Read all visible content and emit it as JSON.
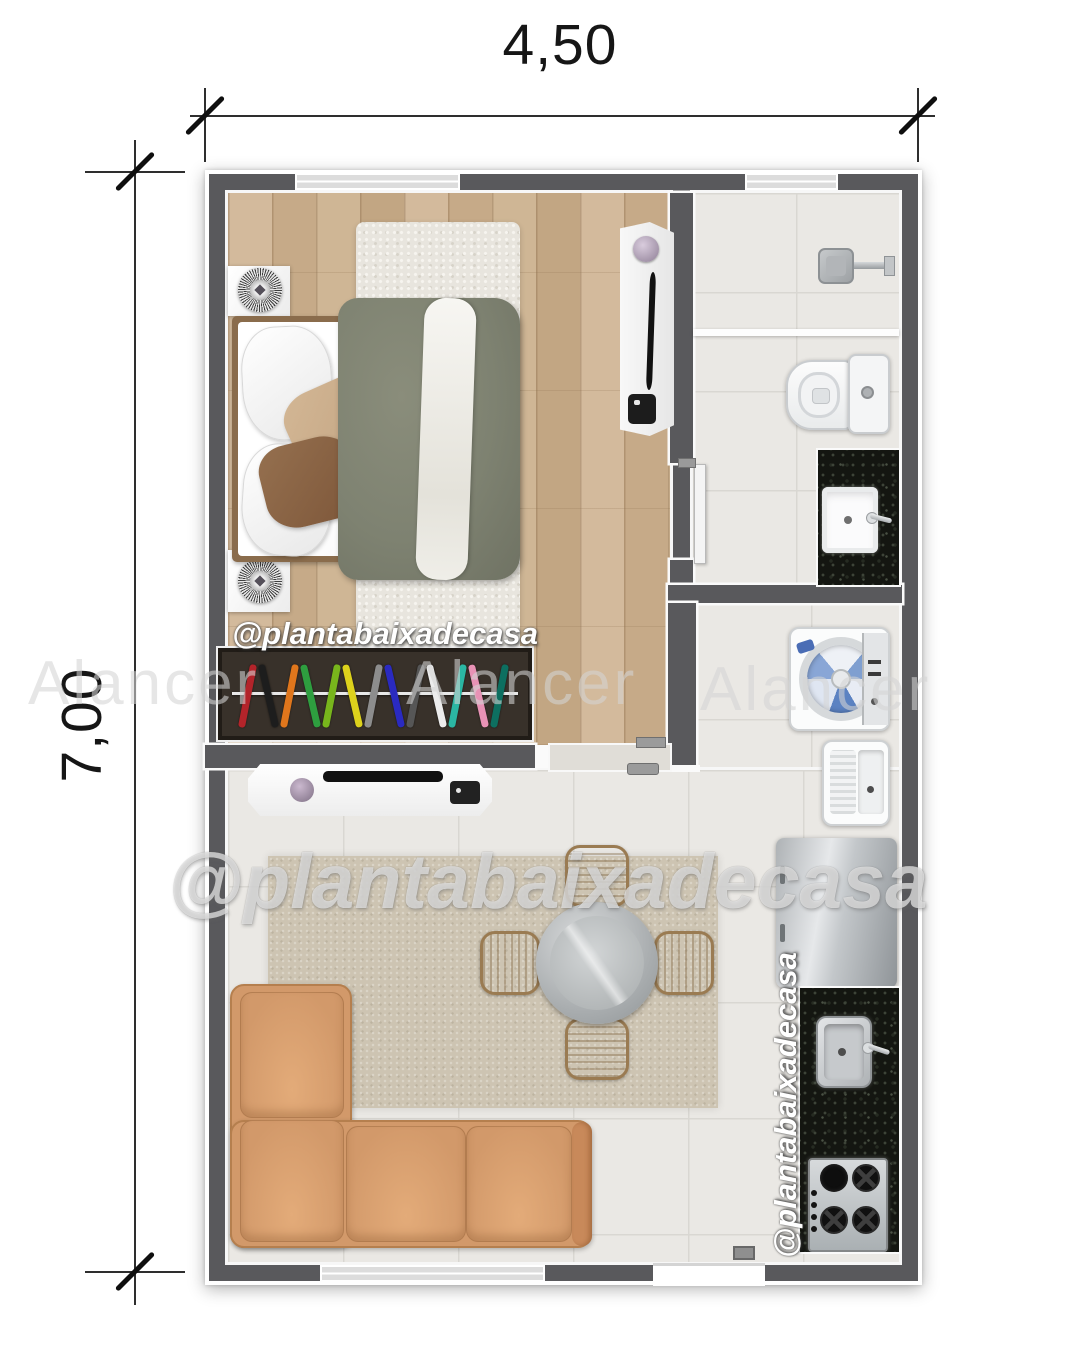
{
  "dimensions": {
    "width": "4,50",
    "height": "7,00"
  },
  "watermarks": {
    "handle": "@plantabaixadecasa",
    "signature": "Alancer"
  },
  "palette": {
    "wall": "#59595c",
    "wood_floor": "#cdb497",
    "tile_floor": "#eae8e4",
    "granite_counter": "#141611",
    "sofa": "#d2996a",
    "living_rug": "#cdc4b2",
    "bed_blanket": "#7e8271",
    "pillow_beige": "#c9ab8b",
    "pillow_brown": "#8a6243"
  },
  "closet_hanger_colors": [
    "#b3242a",
    "#1d1d1d",
    "#e0761c",
    "#2e9e3f",
    "#78b51c",
    "#ddd21c",
    "#8d8d8d",
    "#2a2ac0",
    "#565656",
    "#ececec",
    "#2bb6a3",
    "#e892b5",
    "#0d6f60"
  ],
  "furniture_inventory": [
    "double-bed",
    "nightstand",
    "nightstand",
    "closet-rack",
    "wardrobe-unit",
    "tv-console",
    "l-shaped-sofa",
    "round-dining-table",
    "dining-chair",
    "shower",
    "toilet",
    "bathroom-vanity-sink",
    "washing-machine",
    "laundry-tub",
    "fridge",
    "kitchen-sink",
    "stove"
  ]
}
